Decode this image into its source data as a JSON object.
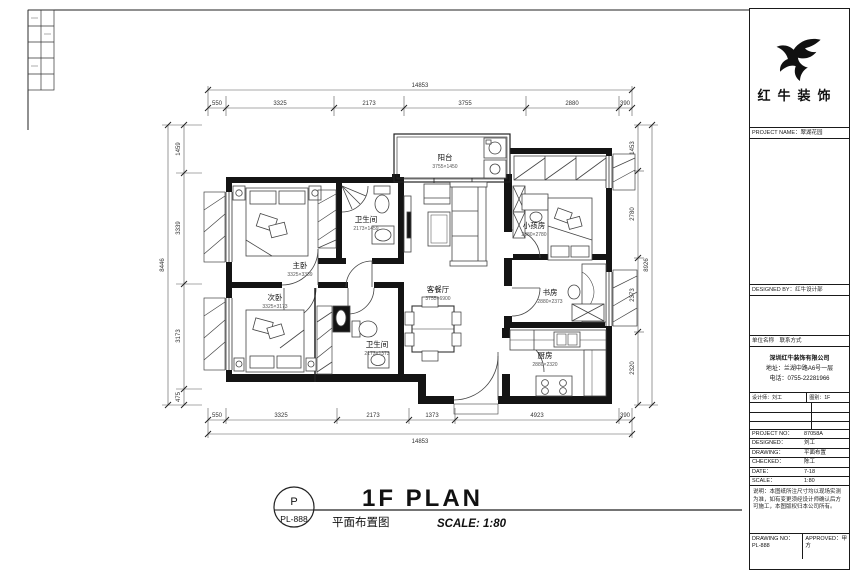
{
  "plan": {
    "rooms": [
      {
        "name": "阳台",
        "sub": "3755×1450"
      },
      {
        "name": "主卧",
        "sub": "3325×3339"
      },
      {
        "name": "卫生间",
        "sub": "2173×1459"
      },
      {
        "name": "客餐厅",
        "sub": "3755×6900"
      },
      {
        "name": "次卧",
        "sub": "3325×3173"
      },
      {
        "name": "卫生间",
        "sub": "2173×1373"
      },
      {
        "name": "小孩房",
        "sub": "2880×2780"
      },
      {
        "name": "书房",
        "sub": "2880×2373"
      },
      {
        "name": "厨房",
        "sub": "2880×2320"
      }
    ],
    "dims": {
      "top_total": "14853",
      "top": [
        "550",
        "3325",
        "2173",
        "3755",
        "2880",
        "390"
      ],
      "bottom": [
        "550",
        "3325",
        "2173",
        "1373",
        "4923",
        "390"
      ],
      "bottom_total": "14853",
      "left": [
        "1459",
        "3339",
        "3173",
        "475"
      ],
      "left_total": "8446",
      "right": [
        "1453",
        "2780",
        "2373",
        "2320"
      ],
      "right_total": "8926"
    }
  },
  "title": {
    "bubble_top": "P",
    "bubble_bottom": "PL-888",
    "main": "1F PLAN",
    "sub_cn": "平面布置图",
    "scale": "SCALE: 1:80"
  },
  "title_block": {
    "brand": "红牛装饰",
    "row_a": "PROJECT NAME：翠湖花园",
    "row_b": "DESIGNED BY：红牛设计部",
    "row_c": "单位名称　联系方式",
    "company": {
      "name": "深圳红牛装饰有限公司",
      "addr": "地址：兰湖中路A6号一层",
      "tel": "电话：0755-22281966"
    },
    "designer_left": "设计师：刘工",
    "designer_right": "图别：1F",
    "rows": [
      {
        "label": "PROJECT NO：",
        "value": "87058A"
      },
      {
        "label": "DESIGNED：",
        "value": "刘工"
      },
      {
        "label": "DRAWING：",
        "value": "平面布置"
      },
      {
        "label": "CHECKED：",
        "value": "陈工"
      },
      {
        "label": "DATE：",
        "value": "7-18"
      },
      {
        "label": "SCALE：",
        "value": "1:80"
      }
    ],
    "notes": "说明：本图纸所注尺寸均以现场实测为准，如有变更须经设计师确认后方可施工，本图版权归本公司所有。",
    "drawing_no_label": "DRAWING NO：",
    "drawing_no": "PL-888",
    "approved_label": "APPROVED：",
    "approved": "甲方"
  }
}
